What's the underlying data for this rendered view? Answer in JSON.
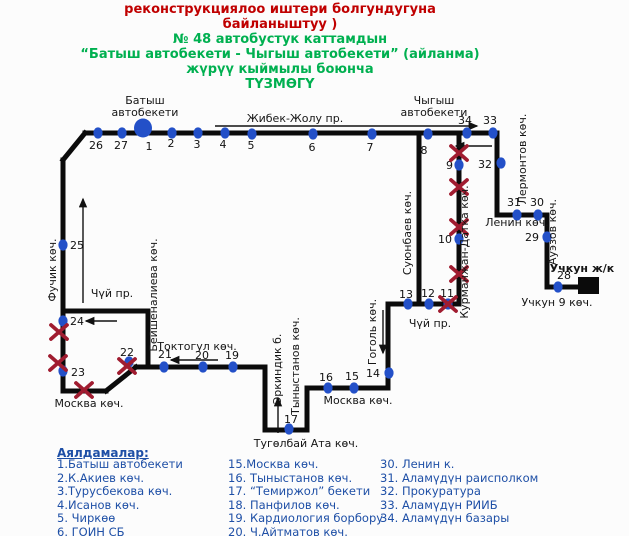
{
  "colors": {
    "route": "#0b0b0b",
    "stop_dot": "#2350c8",
    "closure_x": "#a01c30",
    "title_red": "#c00000",
    "title_green": "#00b050",
    "legend_blue": "#1e4fa6",
    "label_text": "#161616"
  },
  "title": {
    "red_lines": [
      "реконструкциялоо иштери болгундугуна",
      "байланыштуу )"
    ],
    "green_lines": [
      "№ 48 автобустук каттамдын",
      "“Батыш автобекети  -  Чыгыш автобекети” (айланма)",
      "жүрүү кыймылы боюнча",
      "ТҮЗМӨГҮ"
    ]
  },
  "map": {
    "segments": [
      [
        85,
        133,
        497,
        133
      ],
      [
        85,
        133,
        63,
        160
      ],
      [
        63,
        160,
        63,
        391
      ],
      [
        63,
        391,
        106,
        391
      ],
      [
        106,
        391,
        136,
        367
      ],
      [
        136,
        367,
        265,
        367
      ],
      [
        265,
        367,
        265,
        430
      ],
      [
        265,
        430,
        307,
        430
      ],
      [
        307,
        430,
        307,
        388
      ],
      [
        307,
        388,
        388,
        388
      ],
      [
        388,
        388,
        388,
        304
      ],
      [
        388,
        304,
        459,
        304
      ],
      [
        459,
        304,
        459,
        133
      ],
      [
        419,
        133,
        419,
        304
      ],
      [
        63,
        311,
        148,
        311
      ],
      [
        148,
        311,
        148,
        367
      ],
      [
        497,
        133,
        497,
        215
      ],
      [
        497,
        215,
        547,
        215
      ],
      [
        547,
        215,
        547,
        287
      ],
      [
        547,
        287,
        583,
        287
      ]
    ],
    "terminal_square": [
      578,
      277,
      21,
      17
    ],
    "arrows": [
      [
        215,
        126,
        477,
        126
      ],
      [
        492,
        146,
        456,
        146
      ],
      [
        117,
        321,
        86,
        321
      ],
      [
        83,
        303,
        83,
        199
      ],
      [
        218,
        360,
        171,
        360
      ],
      [
        278,
        433,
        278,
        398
      ],
      [
        383,
        310,
        383,
        353
      ]
    ],
    "stops": [
      {
        "n": "26",
        "x": 98,
        "y": 133,
        "lx": 96,
        "ly": 149
      },
      {
        "n": "27",
        "x": 122,
        "y": 133,
        "lx": 121,
        "ly": 149
      },
      {
        "n": "1",
        "x": 143,
        "y": 128,
        "lx": 149,
        "ly": 150,
        "big": true
      },
      {
        "n": "2",
        "x": 172,
        "y": 133,
        "lx": 171,
        "ly": 147
      },
      {
        "n": "3",
        "x": 198,
        "y": 133,
        "lx": 197,
        "ly": 148
      },
      {
        "n": "4",
        "x": 225,
        "y": 133,
        "lx": 223,
        "ly": 148
      },
      {
        "n": "5",
        "x": 252,
        "y": 134,
        "lx": 251,
        "ly": 149
      },
      {
        "n": "6",
        "x": 313,
        "y": 134,
        "lx": 312,
        "ly": 151
      },
      {
        "n": "7",
        "x": 372,
        "y": 134,
        "lx": 370,
        "ly": 151
      },
      {
        "n": "8",
        "x": 428,
        "y": 134,
        "lx": 424,
        "ly": 154
      },
      {
        "n": "34",
        "x": 467,
        "y": 133,
        "lx": 465,
        "ly": 124
      },
      {
        "n": "33",
        "x": 493,
        "y": 133,
        "lx": 490,
        "ly": 124
      },
      {
        "n": "32",
        "x": 501,
        "y": 163,
        "lx": 492,
        "ly": 168,
        "a": "end"
      },
      {
        "n": "31",
        "x": 517,
        "y": 215,
        "lx": 514,
        "ly": 206
      },
      {
        "n": "30",
        "x": 538,
        "y": 215,
        "lx": 537,
        "ly": 206
      },
      {
        "n": "29",
        "x": 547,
        "y": 237,
        "lx": 539,
        "ly": 241,
        "a": "end"
      },
      {
        "n": "28",
        "x": 558,
        "y": 287,
        "lx": 564,
        "ly": 279
      },
      {
        "n": "9",
        "x": 459,
        "y": 165,
        "lx": 453,
        "ly": 169,
        "a": "end"
      },
      {
        "n": "10",
        "x": 459,
        "y": 239,
        "lx": 452,
        "ly": 243,
        "a": "end"
      },
      {
        "n": "11",
        "x": 448,
        "y": 304,
        "lx": 447,
        "ly": 297
      },
      {
        "n": "12",
        "x": 429,
        "y": 304,
        "lx": 428,
        "ly": 297
      },
      {
        "n": "13",
        "x": 408,
        "y": 304,
        "lx": 406,
        "ly": 298
      },
      {
        "n": "14",
        "x": 389,
        "y": 373,
        "lx": 380,
        "ly": 377,
        "a": "end"
      },
      {
        "n": "15",
        "x": 354,
        "y": 388,
        "lx": 352,
        "ly": 380
      },
      {
        "n": "16",
        "x": 328,
        "y": 388,
        "lx": 326,
        "ly": 381
      },
      {
        "n": "17",
        "x": 289,
        "y": 429,
        "lx": 291,
        "ly": 423
      },
      {
        "n": "19",
        "x": 233,
        "y": 367,
        "lx": 232,
        "ly": 359
      },
      {
        "n": "20",
        "x": 203,
        "y": 367,
        "lx": 202,
        "ly": 359
      },
      {
        "n": "21",
        "x": 164,
        "y": 367,
        "lx": 165,
        "ly": 358
      },
      {
        "n": "22",
        "x": 129,
        "y": 362,
        "lx": 127,
        "ly": 356
      },
      {
        "n": "23",
        "x": 63,
        "y": 371,
        "lx": 71,
        "ly": 376,
        "a": "start"
      },
      {
        "n": "24",
        "x": 63,
        "y": 321,
        "lx": 70,
        "ly": 325,
        "a": "start"
      },
      {
        "n": "25",
        "x": 63,
        "y": 245,
        "lx": 70,
        "ly": 249,
        "a": "start"
      }
    ],
    "closures": [
      [
        59,
        332
      ],
      [
        58,
        363
      ],
      [
        84,
        390
      ],
      [
        127,
        366
      ],
      [
        459,
        153
      ],
      [
        459,
        187
      ],
      [
        459,
        227
      ],
      [
        459,
        274
      ],
      [
        448,
        304
      ]
    ],
    "street_labels": [
      {
        "t": "Батыш",
        "x": 145,
        "y": 104
      },
      {
        "t": "автобекети",
        "x": 145,
        "y": 116
      },
      {
        "t": "Чыгыш",
        "x": 434,
        "y": 104
      },
      {
        "t": "автобекети",
        "x": 434,
        "y": 116
      },
      {
        "t": "Жибек-Жолу пр.",
        "x": 295,
        "y": 122
      },
      {
        "t": "Фучик көч.",
        "x": 56,
        "y": 270,
        "rot": true
      },
      {
        "t": "Чүй пр.",
        "x": 112,
        "y": 297
      },
      {
        "t": "Бейшеналиева көч.",
        "x": 157,
        "y": 295,
        "rot": true
      },
      {
        "t": "Токтогул көч.",
        "x": 197,
        "y": 350
      },
      {
        "t": "Эркиндик б.",
        "x": 281,
        "y": 369,
        "rot": true
      },
      {
        "t": "Тыныстанов көч.",
        "x": 299,
        "y": 366,
        "rot": true
      },
      {
        "t": "Тугөлбай Ата көч.",
        "x": 306,
        "y": 447
      },
      {
        "t": "Москва көч.",
        "x": 89,
        "y": 407
      },
      {
        "t": "Москва көч.",
        "x": 358,
        "y": 404
      },
      {
        "t": "Гоголь көч.",
        "x": 376,
        "y": 332,
        "rot": true
      },
      {
        "t": "Чүй пр.",
        "x": 430,
        "y": 327
      },
      {
        "t": "Суюнбаев көч.",
        "x": 411,
        "y": 233,
        "rot": true
      },
      {
        "t": "Курманжан-Датка көч.",
        "x": 468,
        "y": 252,
        "rot": true
      },
      {
        "t": "Лермонтов көч.",
        "x": 526,
        "y": 159,
        "rot": true
      },
      {
        "t": "Ленин көч.",
        "x": 517,
        "y": 226
      },
      {
        "t": "Ауэзов көч.",
        "x": 556,
        "y": 232,
        "rot": true
      },
      {
        "t": "Учкун ж/к",
        "x": 582,
        "y": 272,
        "bold": true
      },
      {
        "t": "Учкун 9 көч.",
        "x": 557,
        "y": 306
      }
    ]
  },
  "legend": {
    "heading": "Аялдамалар:",
    "columns": [
      [
        "1.Батыш автобекети",
        "2.К.Акиев көч.",
        "3.Турусбекова көч.",
        "4.Исанов көч.",
        "5. Чиркөө",
        "6. ГОИН СБ"
      ],
      [
        "15.Москва көч.",
        "16. Тыныстанов көч.",
        "17. “Темиржол” бекети",
        "18. Панфилов көч.",
        "19. Кардиология борбору",
        "20. Ч.Айтматов көч."
      ],
      [
        "30. Ленин к.",
        "31. Аламүдүн раисполком",
        "32. Прокуратура",
        "33. Аламүдүн РИИБ",
        "34. Аламүдүн базары"
      ]
    ]
  }
}
